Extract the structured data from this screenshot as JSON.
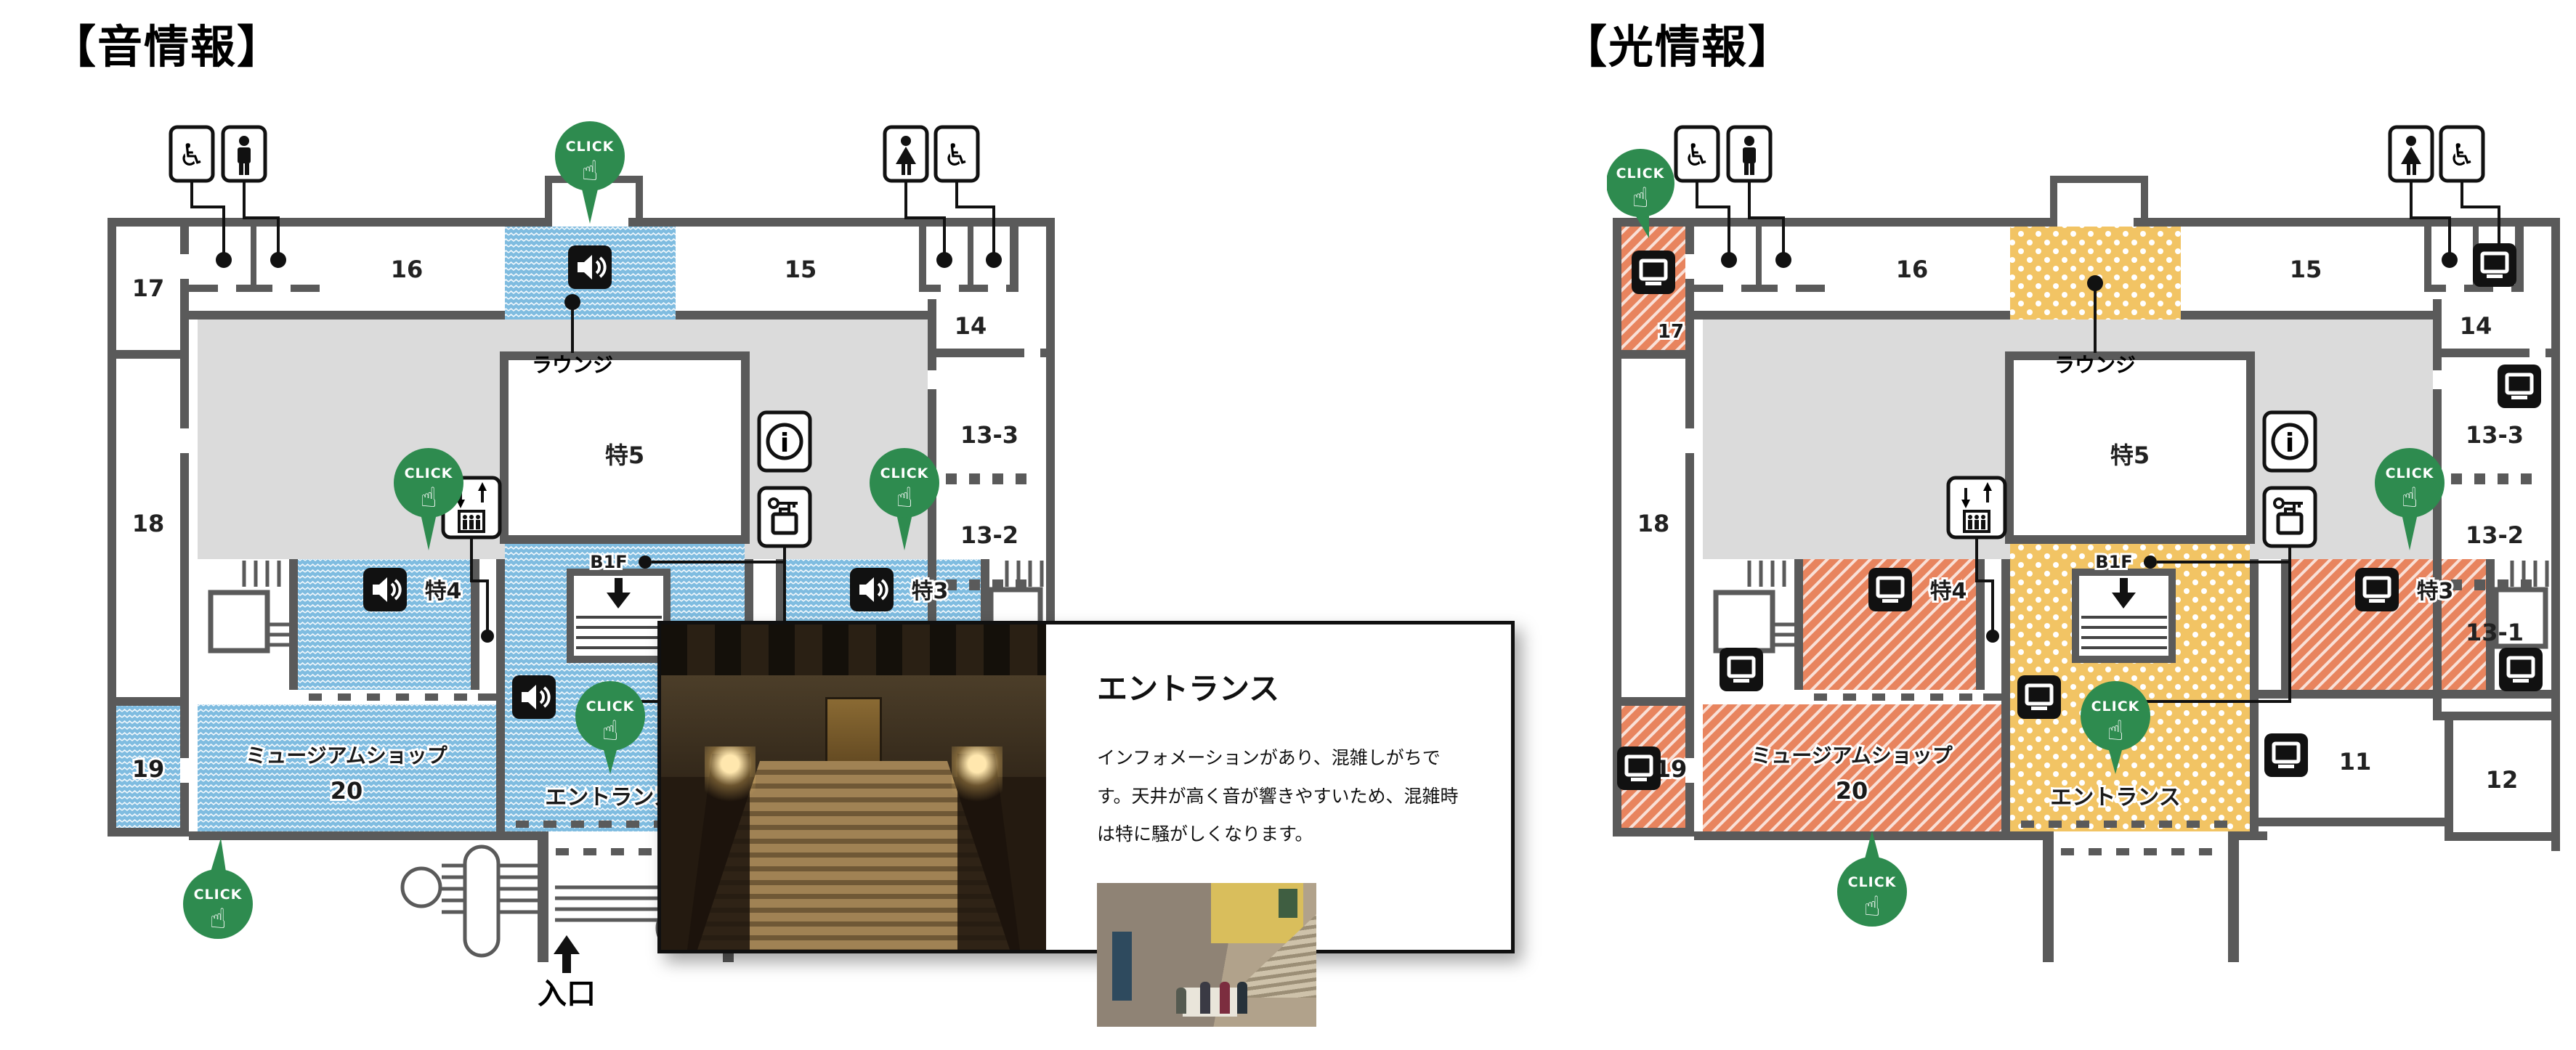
{
  "maps": {
    "sound": {
      "title": "【音情報】"
    },
    "light": {
      "title": "【光情報】"
    }
  },
  "labels": {
    "click": "CLICK",
    "lounge": "ラウンジ",
    "entrance_hall": "エントランス",
    "museum_shop": "ミュージアムショップ",
    "b1f": "B1F",
    "entrance_gate": "入口"
  },
  "rooms": {
    "r11": "11",
    "r12": "12",
    "r13_1": "13-1",
    "r13_2": "13-2",
    "r13_3": "13-3",
    "r14": "14",
    "r15": "15",
    "r16": "16",
    "r17": "17",
    "r18": "18",
    "r19": "19",
    "r20": "20",
    "t3": "特3",
    "t4": "特4",
    "t5": "特5"
  },
  "popup": {
    "title": "エントランス",
    "body": "インフォメーションがあり、混雑しがちです。天井が高く音が響きやすいため、混雑時は特に騒がしくなります。"
  },
  "colors": {
    "sound_highlight": "#7FBCE0",
    "light_stripe": "#E8845E",
    "light_dot": "#F2C464",
    "click_green": "#2E8B4F",
    "wall": "#5A5A5A",
    "hall_gray": "#DBDBDB"
  }
}
